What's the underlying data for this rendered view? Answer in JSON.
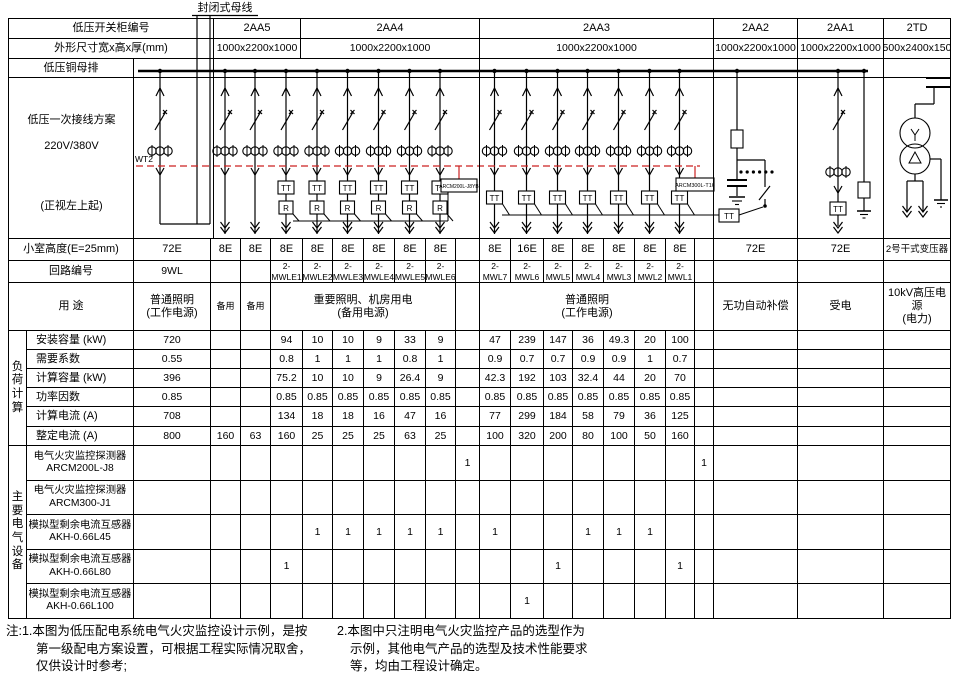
{
  "header": {
    "cabinet_row_label": "低压开关柜编号",
    "dimension_row_label": "外形尺寸宽x高x厚(mm)",
    "busbar_row_label": "低压铜母排",
    "cabinets": [
      {
        "id": "2AA5",
        "dim": "1000x2200x1000"
      },
      {
        "id": "2AA4",
        "dim": "1000x2200x1000"
      },
      {
        "id": "2AA3",
        "dim": "1000x2200x1000"
      },
      {
        "id": "2AA2",
        "dim": "1000x2200x1000"
      },
      {
        "id": "2AA1",
        "dim": "1000x2200x1000"
      },
      {
        "id": "2TD",
        "dim": "2500x2400x1500"
      }
    ]
  },
  "scheme": {
    "cell_label_line1": "低压一次接线方案",
    "cell_label_line2": "220V/380V",
    "cell_label_line3": "(正视左上起)",
    "busway_label": "封闭式母线",
    "wire_label": "WT2",
    "monitor_box_left": "ARCM200L-J8YB",
    "monitor_box_right": "ARCM300L-T16",
    "tt_label": "TT",
    "r_label": "R"
  },
  "rows": {
    "room_height_label": "小室高度(E=25mm)",
    "circuit_label": "回路编号",
    "usage_label": "用  途",
    "load_group_label": "负荷计算",
    "load_row_labels": [
      "安装容量  (kW)",
      "需要系数",
      "计算容量  (kW)",
      "功率因数",
      "计算电流  (A)",
      "整定电流  (A)"
    ],
    "device_group_label": "主要电气设备",
    "device_row_labels": [
      "电气火灾监控探测器\nARCM200L-J8",
      "电气火灾监控探测器\nARCM300-J1",
      "模拟型剩余电流互感器\nAKH-0.66L45",
      "模拟型剩余电流互感器\nAKH-0.66L80",
      "模拟型剩余电流互感器\nAKH-0.66L100"
    ]
  },
  "usages": [
    "普通照明\n(工作电源)",
    "备用",
    "备用",
    "重要照明、机房用电\n(备用电源)",
    "普通照明\n(工作电源)",
    "无功自动补偿",
    "受电",
    "10kV高压电源\n(电力)"
  ],
  "columns": [
    {
      "key": "9WL",
      "room_height": "72E",
      "circuit": "9WL",
      "load": [
        "720",
        "0.55",
        "396",
        "0.85",
        "708",
        "800"
      ],
      "devices": [
        "",
        "",
        "",
        "",
        ""
      ]
    },
    {
      "key": "spare-1",
      "room_height": "8E",
      "circuit": "",
      "load": [
        "",
        "",
        "",
        "",
        "",
        "160"
      ],
      "devices": [
        "",
        "",
        "",
        "",
        ""
      ]
    },
    {
      "key": "spare-2",
      "room_height": "8E",
      "circuit": "",
      "load": [
        "",
        "",
        "",
        "",
        "",
        "63"
      ],
      "devices": [
        "",
        "",
        "",
        "",
        ""
      ]
    },
    {
      "key": "2-MWLE1",
      "room_height": "8E",
      "circuit": "2-MWLE1",
      "load": [
        "94",
        "0.8",
        "75.2",
        "0.85",
        "134",
        "160"
      ],
      "devices": [
        "",
        "",
        "",
        "1",
        ""
      ]
    },
    {
      "key": "2-MWLE2",
      "room_height": "8E",
      "circuit": "2-MWLE2",
      "load": [
        "10",
        "1",
        "10",
        "0.85",
        "18",
        "25"
      ],
      "devices": [
        "",
        "",
        "1",
        "",
        ""
      ]
    },
    {
      "key": "2-MWLE3",
      "room_height": "8E",
      "circuit": "2-MWLE3",
      "load": [
        "10",
        "1",
        "10",
        "0.85",
        "18",
        "25"
      ],
      "devices": [
        "",
        "",
        "1",
        "",
        ""
      ]
    },
    {
      "key": "2-MWLE4",
      "room_height": "8E",
      "circuit": "2-MWLE4",
      "load": [
        "9",
        "1",
        "9",
        "0.85",
        "16",
        "25"
      ],
      "devices": [
        "",
        "",
        "1",
        "",
        ""
      ]
    },
    {
      "key": "2-MWLE5",
      "room_height": "8E",
      "circuit": "2-MWLE5",
      "load": [
        "33",
        "0.8",
        "26.4",
        "0.85",
        "47",
        "63"
      ],
      "devices": [
        "",
        "",
        "1",
        "",
        ""
      ]
    },
    {
      "key": "2-MWLE6",
      "room_height": "8E",
      "circuit": "2-MWLE6",
      "load": [
        "9",
        "1",
        "9",
        "0.85",
        "16",
        "25"
      ],
      "devices": [
        "",
        "",
        "1",
        "",
        ""
      ]
    },
    {
      "key": "aux-left",
      "room_height": "",
      "circuit": "",
      "load": [
        "",
        "",
        "",
        "",
        "",
        ""
      ],
      "devices": [
        "1",
        "",
        "",
        "",
        ""
      ]
    },
    {
      "key": "2-MWL7",
      "room_height": "8E",
      "circuit": "2-MWL7",
      "load": [
        "47",
        "0.9",
        "42.3",
        "0.85",
        "77",
        "100"
      ],
      "devices": [
        "",
        "",
        "1",
        "",
        ""
      ]
    },
    {
      "key": "2-MWL6",
      "room_height": "16E",
      "circuit": "2-MWL6",
      "load": [
        "239",
        "0.7",
        "192",
        "0.85",
        "299",
        "320"
      ],
      "devices": [
        "",
        "",
        "",
        "",
        "1"
      ]
    },
    {
      "key": "2-MWL5",
      "room_height": "8E",
      "circuit": "2-MWL5",
      "load": [
        "147",
        "0.7",
        "103",
        "0.85",
        "184",
        "200"
      ],
      "devices": [
        "",
        "",
        "",
        "1",
        ""
      ]
    },
    {
      "key": "2-MWL4",
      "room_height": "8E",
      "circuit": "2-MWL4",
      "load": [
        "36",
        "0.9",
        "32.4",
        "0.85",
        "58",
        "80"
      ],
      "devices": [
        "",
        "",
        "1",
        "",
        ""
      ]
    },
    {
      "key": "2-MWL3",
      "room_height": "8E",
      "circuit": "2-MWL3",
      "load": [
        "49.3",
        "0.9",
        "44",
        "0.85",
        "79",
        "100"
      ],
      "devices": [
        "",
        "",
        "1",
        "",
        ""
      ]
    },
    {
      "key": "2-MWL2",
      "room_height": "8E",
      "circuit": "2-MWL2",
      "load": [
        "20",
        "1",
        "20",
        "0.85",
        "36",
        "50"
      ],
      "devices": [
        "",
        "",
        "1",
        "",
        ""
      ]
    },
    {
      "key": "2-MWL1",
      "room_height": "8E",
      "circuit": "2-MWL1",
      "load": [
        "100",
        "0.7",
        "70",
        "0.85",
        "125",
        "160"
      ],
      "devices": [
        "",
        "",
        "",
        "1",
        ""
      ]
    },
    {
      "key": "aux-right",
      "room_height": "",
      "circuit": "",
      "load": [
        "",
        "",
        "",
        "",
        "",
        ""
      ],
      "devices": [
        "1",
        "",
        "",
        "",
        ""
      ]
    },
    {
      "key": "2AA2-col",
      "room_height": "72E",
      "circuit": "",
      "load": [
        "",
        "",
        "",
        "",
        "",
        ""
      ],
      "devices": [
        "",
        "",
        "",
        "",
        ""
      ]
    },
    {
      "key": "2AA1-col",
      "room_height": "72E",
      "circuit": "",
      "load": [
        "",
        "",
        "",
        "",
        "",
        ""
      ],
      "devices": [
        "",
        "",
        "",
        "",
        ""
      ]
    },
    {
      "key": "2TD-col",
      "room_height": "2号干式变压器",
      "circuit": "",
      "load": [
        "",
        "",
        "",
        "",
        "",
        ""
      ],
      "devices": [
        "",
        "",
        "",
        "",
        ""
      ]
    }
  ],
  "notes": {
    "note1": "注:1.本图为低压配电系统电气火灾监控设计示例，是按\n第一级配电方案设置，可根据工程实际情况取舍，\n仅供设计时参考;",
    "note2": "2.本图中只注明电气火灾监控产品的选型作为\n示例，其他电气产品的选型及技术性能要求\n等，均由工程设计确定。"
  },
  "colors": {
    "line": "#000000",
    "monitor_bus": "#cc2222",
    "background": "#ffffff"
  }
}
